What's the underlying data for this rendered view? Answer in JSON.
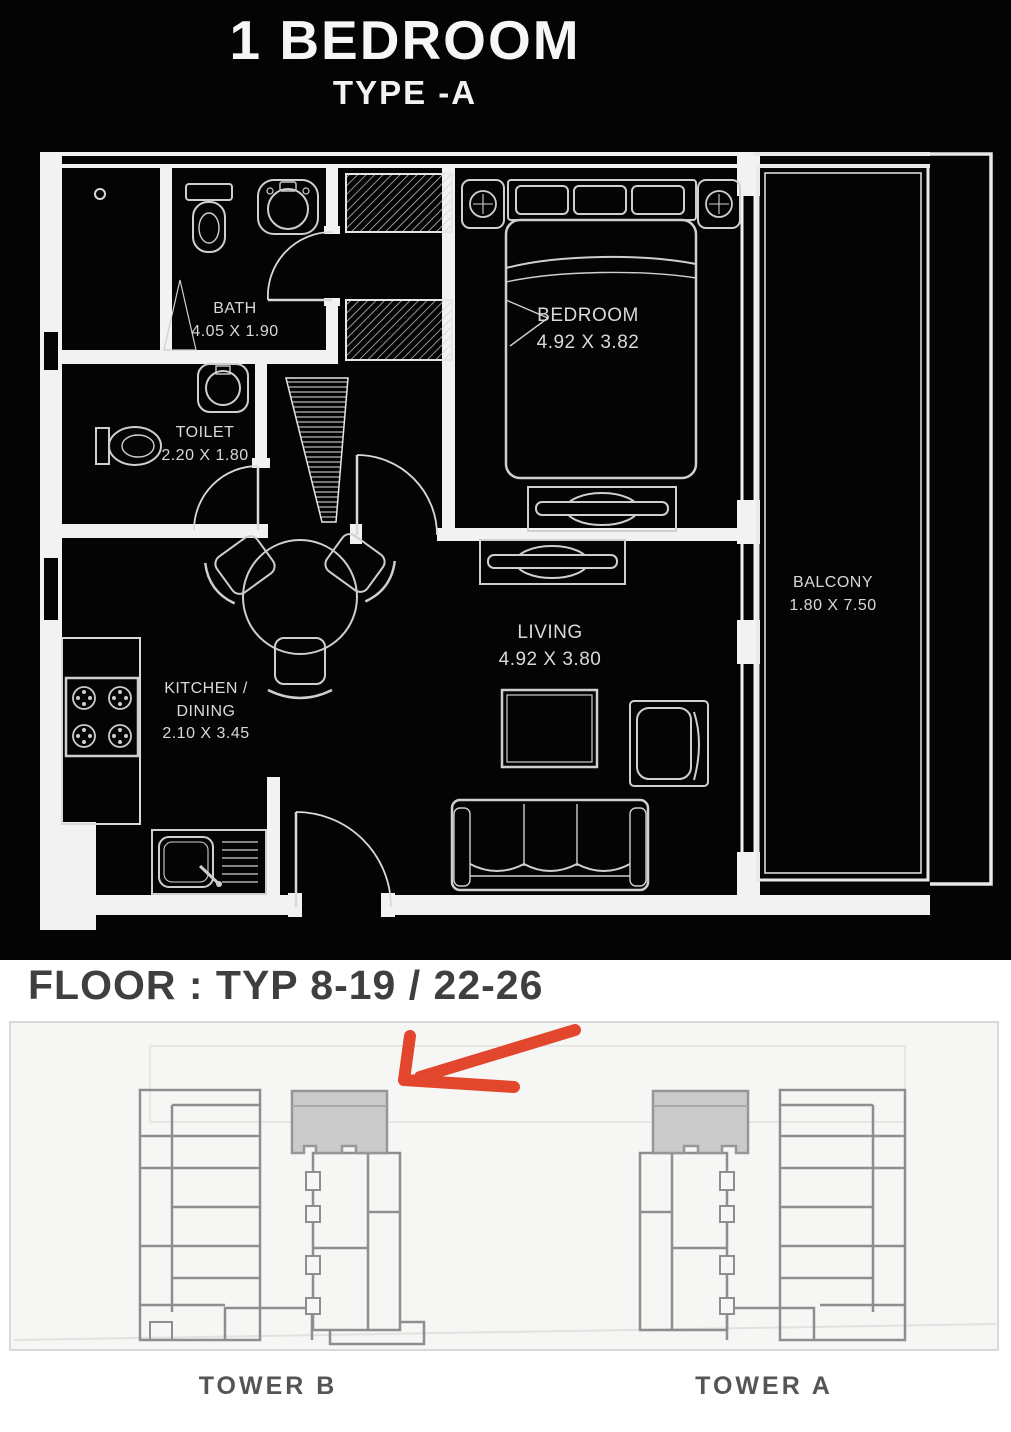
{
  "header": {
    "title": "1 BEDROOM",
    "subtitle": "TYPE -A"
  },
  "floorplan": {
    "background": "#040404",
    "line_color": "#f2f2f2",
    "rooms": {
      "bath": {
        "name": "BATH",
        "dims": "4.05 X 1.90"
      },
      "toilet": {
        "name": "TOILET",
        "dims": "2.20 X 1.80"
      },
      "bedroom": {
        "name": "BEDROOM",
        "dims": "4.92 X 3.82"
      },
      "kitchen_dining": {
        "name_line1": "KITCHEN /",
        "name_line2": "DINING",
        "dims": "2.10 X 3.45"
      },
      "living": {
        "name": "LIVING",
        "dims": "4.92 X 3.80"
      },
      "balcony": {
        "name": "BALCONY",
        "dims": "1.80 X 7.50"
      }
    }
  },
  "floor_locator": {
    "heading": "FLOOR : TYP 8-19 / 22-26",
    "towers": [
      {
        "label": "TOWER B"
      },
      {
        "label": "TOWER A"
      }
    ],
    "arrow_points_to": "TOWER B",
    "arrow_color": "#e2462c",
    "unit_highlight_color": "#cbcbcb",
    "outline_color": "#8e8e8e"
  }
}
